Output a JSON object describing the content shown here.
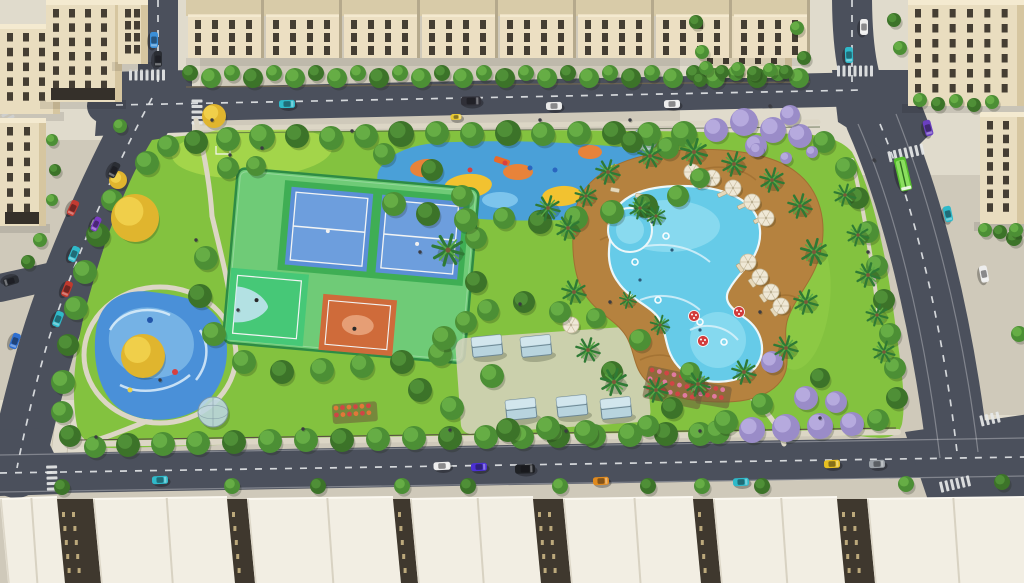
{
  "scene": {
    "kind": "aerial-architectural-render",
    "subject": "residential-park-with-pool-and-courts"
  },
  "colors": {
    "base": "#cfc9ba",
    "plaza": "#e0dbcc",
    "road": "#4b505c",
    "road_line": "#e4e7e9",
    "park_grass": "#83c23f",
    "lawn": "#a6d74b",
    "path": "#dcd6c5",
    "tree_green": "#4c8f35",
    "tree_green_hi": "#66ad45",
    "tree_dark": "#3c7329",
    "tree_dark_hi": "#4f8f37",
    "tree_yellow": "#e0b52e",
    "tree_yellow_hi": "#f0cf4a",
    "tree_purple": "#9a8cc8",
    "tree_purple_hi": "#b6aade",
    "palm": "#2f7a35",
    "palm_hi": "#58a945",
    "trunk": "#7a5b3a",
    "pool_water": "#66cbe8",
    "pool_light": "#8ddcf0",
    "pool_swirl": "#def3fa",
    "pool_edge": "#ecf7f9",
    "deck": "#b5823f",
    "deck_dark": "#96682c",
    "splash_base": "#4a90d8",
    "splash_light": "#7cb9e8",
    "splash_swirl": "#ddeffa",
    "pg_base": "#4aa0d8",
    "pg_yellow": "#f2c230",
    "pg_orange": "#e8833a",
    "pg_blue": "#7cc4ec",
    "pg_slide": "#e86a2a",
    "court_surround": "#6fcb77",
    "court_green": "#3fae54",
    "court_blue": "#5b8fd6",
    "court_blue_hi": "#6d9edd",
    "bball_green": "#46c877",
    "bball_zone": "#bfe3ee",
    "court_orange": "#cf6b3a",
    "court_orange_hi": "#e8a47c",
    "fence": "#2e8b45",
    "line_white": "#f2f4f4",
    "wall": "#e9ddbf",
    "wall_shade": "#d6c6a0",
    "wall_light": "#f4ead0",
    "win": "#453e33",
    "storefront": "#35302a",
    "roof_white": "#f2eee3",
    "roof_hi": "#fbf8f0",
    "roof_line": "#d8d2c2",
    "facade_dark": "#3f382e",
    "facade_win": "#cab684",
    "umbrella": "#efe8d6",
    "umbrella_rib": "#c9bda0",
    "lounger": "#e6d9bc",
    "mushroom": "#d23c3c",
    "pavilion_glass": "#b8d4de",
    "pavilion_glass_hi": "#d8eaf0",
    "pavilion_frame": "#6e8894",
    "flower_red": "#d04545",
    "flower_pink": "#e07aa0",
    "flower_orange": "#e07838",
    "soil": "#6b5a3a",
    "dome_glass": "#c3dde8",
    "dome_frame": "#7e95a2",
    "hedge_fence": "#6b6352",
    "park_fence": "#5a5243",
    "shadow": "rgba(25,30,15,0.22)",
    "person": "#3b3b42",
    "bus_green": "#56bd2d",
    "bus_roof": "#8ade5e",
    "planter_green": "#3fae3f"
  },
  "cars": [
    [
      73,
      208,
      115,
      16,
      8,
      "#c23b32",
      "red-car"
    ],
    [
      96,
      224,
      115,
      15,
      7,
      "#7a3cc4",
      "purple-car"
    ],
    [
      74,
      254,
      113,
      16,
      8,
      "#2fb9c9",
      "teal-car"
    ],
    [
      67,
      289,
      112,
      16,
      8,
      "#c03a2e",
      "red-car"
    ],
    [
      58,
      319,
      111,
      16,
      8,
      "#2fb9c9",
      "teal-car"
    ],
    [
      15,
      341,
      110,
      16,
      8,
      "#2f6fd0",
      "blue-car"
    ],
    [
      11,
      281,
      163,
      16,
      8,
      "#2a2d33",
      "black-car"
    ],
    [
      154,
      40,
      90,
      16,
      8,
      "#3b8fd8",
      "blue-car"
    ],
    [
      158,
      59,
      90,
      16,
      8,
      "#2a2d33",
      "black-car"
    ],
    [
      114,
      170,
      117,
      16,
      8,
      "#2a2d33",
      "black-car"
    ],
    [
      287,
      104,
      -1,
      16,
      8,
      "#2fb9c9",
      "teal-car"
    ],
    [
      471,
      101,
      -1,
      20,
      9,
      "#303038",
      "black-van"
    ],
    [
      554,
      106,
      -1,
      16,
      8,
      "#e9e9e9",
      "white-car"
    ],
    [
      456,
      117,
      -1,
      11,
      6,
      "#e8c832",
      "yellow-cart"
    ],
    [
      672,
      104,
      -1,
      16,
      8,
      "#ededed",
      "white-car"
    ],
    [
      864,
      27,
      90,
      16,
      8,
      "#ededed",
      "white-car"
    ],
    [
      849,
      55,
      88,
      16,
      8,
      "#2fb9c9",
      "teal-car"
    ],
    [
      928,
      128,
      75,
      16,
      8,
      "#6a3fc0",
      "purple-car"
    ],
    [
      903,
      174,
      77,
      34,
      12,
      "#56bd2d",
      "green-bus"
    ],
    [
      948,
      214,
      78,
      16,
      8,
      "#2fb9c9",
      "teal-car"
    ],
    [
      984,
      274,
      79,
      17,
      8,
      "#ededed",
      "white-car"
    ],
    [
      160,
      480,
      -2,
      16,
      8,
      "#2fb9c9",
      "teal-car"
    ],
    [
      442,
      466,
      -2,
      17,
      8,
      "#eeeeee",
      "white-car"
    ],
    [
      479,
      467,
      -2,
      16,
      8,
      "#4a2fd4",
      "blue-car"
    ],
    [
      525,
      469,
      -2,
      20,
      9,
      "#1f2125",
      "black-suv"
    ],
    [
      601,
      481,
      -2,
      16,
      8,
      "#e08a1e",
      "orange-car"
    ],
    [
      741,
      482,
      -2,
      16,
      8,
      "#2fb9c9",
      "teal-car"
    ],
    [
      832,
      464,
      -2,
      16,
      8,
      "#e8c020",
      "yellow-car"
    ],
    [
      877,
      464,
      -2,
      16,
      8,
      "#9aa0a6",
      "silver-car"
    ]
  ],
  "trees": [
    [
      168,
      146,
      11,
      "g"
    ],
    [
      196,
      142,
      12,
      "d"
    ],
    [
      228,
      139,
      12,
      "g"
    ],
    [
      262,
      137,
      13,
      "g"
    ],
    [
      297,
      136,
      12,
      "d"
    ],
    [
      331,
      138,
      12,
      "g"
    ],
    [
      366,
      136,
      12,
      "g"
    ],
    [
      401,
      134,
      13,
      "d"
    ],
    [
      437,
      133,
      12,
      "g"
    ],
    [
      472,
      134,
      12,
      "g"
    ],
    [
      508,
      133,
      13,
      "d"
    ],
    [
      543,
      134,
      12,
      "g"
    ],
    [
      579,
      133,
      12,
      "g"
    ],
    [
      614,
      133,
      12,
      "d"
    ],
    [
      649,
      134,
      12,
      "g"
    ],
    [
      684,
      134,
      13,
      "g"
    ],
    [
      716,
      130,
      12,
      "p"
    ],
    [
      744,
      122,
      14,
      "p"
    ],
    [
      773,
      130,
      13,
      "p"
    ],
    [
      800,
      136,
      12,
      "p"
    ],
    [
      824,
      142,
      11,
      "g"
    ],
    [
      756,
      146,
      11,
      "p"
    ],
    [
      790,
      115,
      10,
      "p"
    ],
    [
      147,
      163,
      12,
      "g"
    ],
    [
      112,
      200,
      11,
      "g"
    ],
    [
      98,
      235,
      12,
      "d"
    ],
    [
      85,
      272,
      12,
      "g"
    ],
    [
      76,
      308,
      12,
      "g"
    ],
    [
      68,
      345,
      11,
      "d"
    ],
    [
      63,
      382,
      12,
      "g"
    ],
    [
      62,
      412,
      11,
      "g"
    ],
    [
      70,
      436,
      11,
      "d"
    ],
    [
      135,
      218,
      24,
      "y"
    ],
    [
      143,
      356,
      22,
      "y"
    ],
    [
      214,
      116,
      12,
      "y"
    ],
    [
      118,
      180,
      9,
      "y"
    ],
    [
      95,
      447,
      11,
      "g"
    ],
    [
      128,
      445,
      12,
      "d"
    ],
    [
      163,
      444,
      12,
      "g"
    ],
    [
      198,
      443,
      12,
      "g"
    ],
    [
      234,
      442,
      12,
      "d"
    ],
    [
      270,
      441,
      12,
      "g"
    ],
    [
      306,
      440,
      12,
      "g"
    ],
    [
      342,
      440,
      12,
      "d"
    ],
    [
      378,
      439,
      12,
      "g"
    ],
    [
      414,
      438,
      12,
      "g"
    ],
    [
      450,
      438,
      12,
      "d"
    ],
    [
      486,
      437,
      12,
      "g"
    ],
    [
      522,
      437,
      12,
      "g"
    ],
    [
      558,
      436,
      12,
      "d"
    ],
    [
      594,
      436,
      12,
      "g"
    ],
    [
      630,
      435,
      12,
      "g"
    ],
    [
      666,
      434,
      12,
      "d"
    ],
    [
      700,
      434,
      12,
      "g"
    ],
    [
      718,
      432,
      12,
      "g"
    ],
    [
      752,
      430,
      13,
      "p"
    ],
    [
      786,
      428,
      14,
      "p"
    ],
    [
      820,
      426,
      13,
      "p"
    ],
    [
      852,
      424,
      12,
      "p"
    ],
    [
      878,
      420,
      11,
      "g"
    ],
    [
      846,
      168,
      11,
      "g"
    ],
    [
      858,
      198,
      11,
      "d"
    ],
    [
      868,
      232,
      11,
      "g"
    ],
    [
      877,
      266,
      11,
      "g"
    ],
    [
      884,
      300,
      11,
      "d"
    ],
    [
      890,
      334,
      11,
      "g"
    ],
    [
      895,
      368,
      11,
      "g"
    ],
    [
      897,
      398,
      11,
      "d"
    ],
    [
      228,
      168,
      11,
      "g"
    ],
    [
      256,
      166,
      10,
      "g"
    ],
    [
      206,
      258,
      12,
      "g"
    ],
    [
      200,
      296,
      12,
      "d"
    ],
    [
      214,
      334,
      12,
      "g"
    ],
    [
      244,
      362,
      12,
      "g"
    ],
    [
      282,
      372,
      12,
      "d"
    ],
    [
      322,
      370,
      12,
      "g"
    ],
    [
      362,
      366,
      12,
      "g"
    ],
    [
      402,
      362,
      12,
      "d"
    ],
    [
      440,
      354,
      12,
      "g"
    ],
    [
      466,
      322,
      11,
      "g"
    ],
    [
      476,
      282,
      11,
      "d"
    ],
    [
      476,
      238,
      11,
      "g"
    ],
    [
      462,
      196,
      11,
      "g"
    ],
    [
      432,
      170,
      11,
      "d"
    ],
    [
      384,
      154,
      11,
      "g"
    ],
    [
      394,
      204,
      12,
      "g"
    ],
    [
      428,
      214,
      12,
      "d"
    ],
    [
      466,
      220,
      12,
      "g"
    ],
    [
      504,
      218,
      11,
      "g"
    ],
    [
      540,
      222,
      12,
      "d"
    ],
    [
      576,
      218,
      12,
      "g"
    ],
    [
      612,
      212,
      12,
      "g"
    ],
    [
      646,
      206,
      12,
      "d"
    ],
    [
      678,
      196,
      11,
      "g"
    ],
    [
      700,
      178,
      10,
      "g"
    ],
    [
      668,
      148,
      11,
      "g"
    ],
    [
      632,
      142,
      11,
      "d"
    ],
    [
      444,
      338,
      12,
      "g"
    ],
    [
      420,
      390,
      12,
      "d"
    ],
    [
      452,
      408,
      12,
      "g"
    ],
    [
      492,
      376,
      12,
      "g"
    ],
    [
      508,
      430,
      12,
      "d"
    ],
    [
      548,
      428,
      12,
      "g"
    ],
    [
      586,
      432,
      12,
      "g"
    ],
    [
      612,
      372,
      11,
      "d"
    ],
    [
      640,
      340,
      11,
      "g"
    ],
    [
      648,
      426,
      11,
      "g"
    ],
    [
      672,
      408,
      11,
      "d"
    ],
    [
      690,
      372,
      10,
      "g"
    ],
    [
      560,
      312,
      11,
      "g"
    ],
    [
      524,
      302,
      11,
      "d"
    ],
    [
      488,
      310,
      11,
      "g"
    ],
    [
      596,
      318,
      10,
      "g"
    ],
    [
      726,
      422,
      12,
      "g"
    ],
    [
      762,
      404,
      11,
      "g"
    ],
    [
      806,
      398,
      12,
      "p"
    ],
    [
      836,
      402,
      11,
      "p"
    ],
    [
      820,
      378,
      10,
      "d"
    ],
    [
      772,
      362,
      11,
      "p"
    ],
    [
      62,
      487,
      8,
      "d"
    ],
    [
      232,
      486,
      8,
      "g"
    ],
    [
      318,
      486,
      8,
      "d"
    ],
    [
      402,
      486,
      8,
      "g"
    ],
    [
      468,
      486,
      8,
      "d"
    ],
    [
      560,
      486,
      8,
      "g"
    ],
    [
      648,
      486,
      8,
      "d"
    ],
    [
      702,
      486,
      8,
      "g"
    ],
    [
      762,
      486,
      8,
      "d"
    ],
    [
      906,
      484,
      8,
      "g"
    ],
    [
      1002,
      482,
      8,
      "d"
    ],
    [
      894,
      20,
      7,
      "d"
    ],
    [
      900,
      48,
      7,
      "g"
    ],
    [
      696,
      22,
      7,
      "d"
    ],
    [
      702,
      52,
      7,
      "g"
    ],
    [
      700,
      80,
      7,
      "d"
    ],
    [
      797,
      28,
      7,
      "g"
    ],
    [
      804,
      58,
      7,
      "d"
    ],
    [
      1014,
      238,
      8,
      "d"
    ],
    [
      1019,
      334,
      8,
      "g"
    ],
    [
      920,
      100,
      7,
      "g"
    ],
    [
      938,
      104,
      7,
      "d"
    ],
    [
      956,
      101,
      7,
      "g"
    ],
    [
      974,
      105,
      7,
      "d"
    ],
    [
      992,
      102,
      7,
      "g"
    ],
    [
      706,
      68,
      7,
      "g"
    ],
    [
      722,
      72,
      7,
      "d"
    ],
    [
      738,
      69,
      7,
      "g"
    ],
    [
      754,
      73,
      7,
      "d"
    ],
    [
      770,
      70,
      7,
      "g"
    ],
    [
      786,
      72,
      7,
      "d"
    ],
    [
      985,
      230,
      7,
      "g"
    ],
    [
      1000,
      232,
      7,
      "d"
    ],
    [
      1016,
      230,
      7,
      "g"
    ],
    [
      52,
      140,
      6,
      "g"
    ],
    [
      55,
      170,
      6,
      "d"
    ],
    [
      52,
      200,
      6,
      "g"
    ],
    [
      40,
      240,
      7,
      "g"
    ],
    [
      28,
      262,
      7,
      "d"
    ],
    [
      120,
      126,
      7,
      "g"
    ],
    [
      757,
      150,
      7,
      "p"
    ],
    [
      786,
      158,
      6,
      "p"
    ],
    [
      812,
      152,
      6,
      "p"
    ]
  ],
  "hedge_row": {
    "x1": 190,
    "x2": 808,
    "step": 21
  },
  "palms": [
    [
      568,
      228,
      1
    ],
    [
      574,
      292,
      1
    ],
    [
      588,
      350,
      1
    ],
    [
      614,
      382,
      1.1
    ],
    [
      656,
      390,
      1
    ],
    [
      698,
      384,
      1
    ],
    [
      744,
      372,
      1
    ],
    [
      786,
      348,
      1
    ],
    [
      806,
      302,
      1
    ],
    [
      814,
      252,
      1.1
    ],
    [
      800,
      206,
      1
    ],
    [
      772,
      180,
      1
    ],
    [
      734,
      164,
      1
    ],
    [
      694,
      152,
      1.1
    ],
    [
      650,
      156,
      1
    ],
    [
      608,
      172,
      1
    ],
    [
      586,
      196,
      0.9
    ],
    [
      548,
      208,
      1
    ],
    [
      640,
      208,
      0.9
    ],
    [
      448,
      250,
      1.3
    ],
    [
      845,
      195,
      0.9
    ],
    [
      858,
      235,
      0.9
    ],
    [
      868,
      275,
      1
    ],
    [
      877,
      315,
      0.9
    ],
    [
      884,
      352,
      0.9
    ],
    [
      660,
      325,
      0.8
    ],
    [
      628,
      300,
      0.7
    ],
    [
      656,
      216,
      0.8
    ]
  ],
  "umbrellas": [
    [
      692,
      172
    ],
    [
      712,
      178
    ],
    [
      733,
      188
    ],
    [
      752,
      202
    ],
    [
      766,
      218
    ],
    [
      748,
      262
    ],
    [
      760,
      277
    ],
    [
      771,
      292
    ],
    [
      781,
      306
    ],
    [
      571,
      325
    ]
  ],
  "loungers": [
    [
      702,
      186,
      -25
    ],
    [
      722,
      194,
      -25
    ],
    [
      742,
      206,
      -25
    ],
    [
      758,
      220,
      -30
    ],
    [
      740,
      268,
      55
    ],
    [
      752,
      283,
      55
    ],
    [
      763,
      298,
      55
    ],
    [
      774,
      312,
      55
    ],
    [
      640,
      196,
      10
    ],
    [
      615,
      190,
      10
    ]
  ],
  "mushrooms": [
    [
      694,
      316
    ],
    [
      739,
      312
    ],
    [
      703,
      341
    ]
  ],
  "floats": [
    [
      700,
      322
    ],
    [
      724,
      342
    ],
    [
      648,
      214
    ],
    [
      666,
      236
    ],
    [
      635,
      262
    ],
    [
      658,
      300
    ]
  ],
  "swimmers": [
    [
      652,
      222
    ],
    [
      672,
      250
    ],
    [
      700,
      330
    ],
    [
      640,
      280
    ]
  ],
  "pavilions": [
    [
      487,
      346
    ],
    [
      536,
      346
    ],
    [
      521,
      409
    ],
    [
      572,
      406
    ],
    [
      616,
      408
    ]
  ],
  "domes": [
    [
      213,
      412,
      15
    ],
    [
      645,
      139,
      12
    ]
  ],
  "flowerbeds": [
    {
      "x": 652,
      "y": 370,
      "rot": 12,
      "rows": 3,
      "cols": 7,
      "dx": 7.5,
      "dy": 9,
      "c1": "flower_red",
      "c2": "flower_pink"
    },
    {
      "x": 336,
      "y": 408,
      "rot": -4,
      "rows": 2,
      "cols": 6,
      "dx": 6.5,
      "dy": 7,
      "c1": "flower_orange",
      "c2": "flower_red"
    },
    {
      "x": 702,
      "y": 386,
      "rot": 10,
      "rows": 2,
      "cols": 4,
      "dx": 7,
      "dy": 8,
      "c1": "flower_red",
      "c2": "flower_pink"
    }
  ],
  "buildings": [
    [
      0,
      24,
      60,
      90,
      3,
      5,
      0
    ],
    [
      46,
      0,
      76,
      102,
      4,
      6,
      1
    ],
    [
      118,
      0,
      30,
      64,
      2,
      4,
      0
    ],
    [
      0,
      118,
      46,
      108,
      2,
      6,
      1
    ],
    [
      700,
      0,
      92,
      78,
      5,
      4,
      0
    ],
    [
      908,
      0,
      116,
      106,
      6,
      6,
      0
    ],
    [
      980,
      112,
      44,
      112,
      2,
      7,
      0
    ]
  ],
  "townhouses": {
    "x0": 186,
    "y": 0,
    "unitW": 78,
    "unitH": 58,
    "count": 8
  },
  "rooftops": {
    "y0": 498,
    "slabs": [
      [
        0,
        57
      ],
      [
        93,
        134
      ],
      [
        247,
        146
      ],
      [
        410,
        123
      ],
      [
        563,
        130
      ],
      [
        713,
        124
      ],
      [
        867,
        157
      ]
    ]
  },
  "crosswalks": [
    [
      147,
      75,
      90,
      7
    ],
    [
      197,
      112,
      0,
      5
    ],
    [
      52,
      478,
      -2,
      5
    ],
    [
      906,
      153,
      77,
      7
    ],
    [
      855,
      71,
      90,
      7
    ],
    [
      955,
      484,
      77,
      6
    ],
    [
      990,
      419,
      77,
      4
    ],
    [
      8,
      116,
      150,
      4
    ]
  ],
  "planters": [
    [
      138,
      33
    ],
    [
      133,
      51
    ]
  ],
  "people": [
    [
      196,
      240
    ],
    [
      212,
      120
    ],
    [
      352,
      131
    ],
    [
      420,
      252
    ],
    [
      520,
      304
    ],
    [
      566,
      431
    ],
    [
      610,
      302
    ],
    [
      700,
      431
    ],
    [
      760,
      312
    ],
    [
      820,
      418
    ],
    [
      868,
      252
    ],
    [
      96,
      437
    ],
    [
      303,
      429
    ],
    [
      630,
      120
    ],
    [
      874,
      160
    ],
    [
      770,
      106
    ],
    [
      238,
      310
    ],
    [
      160,
      380
    ],
    [
      450,
      430
    ],
    [
      540,
      120
    ],
    [
      230,
      155
    ],
    [
      262,
      148
    ]
  ]
}
